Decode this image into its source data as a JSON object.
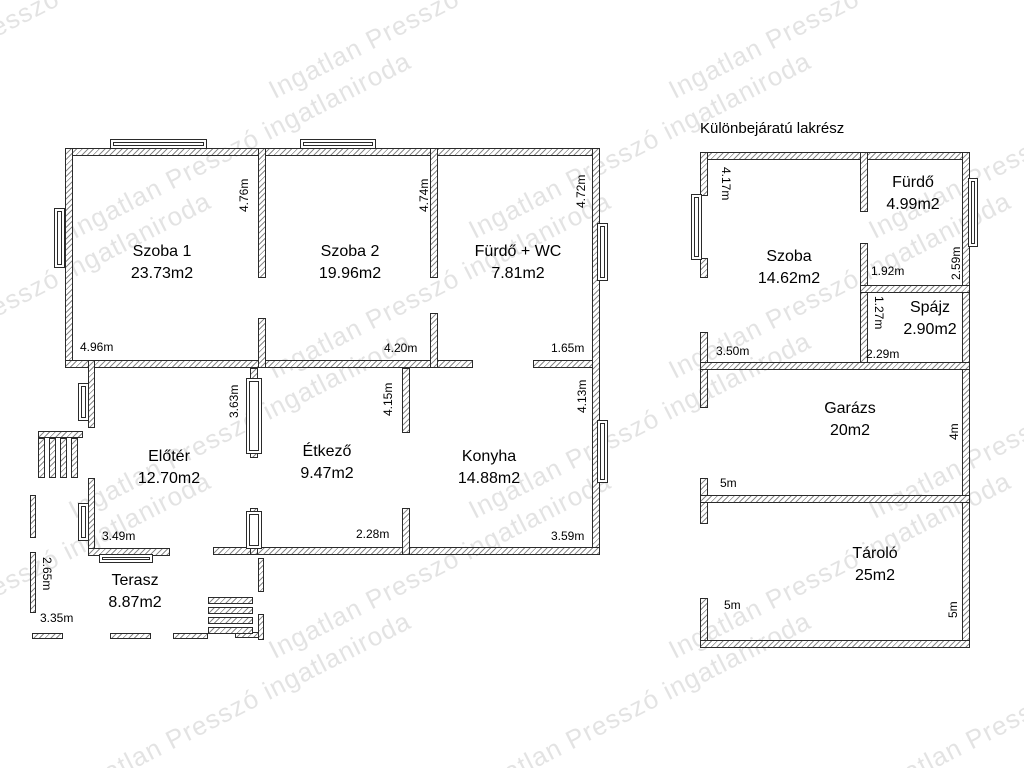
{
  "title": "Különbejáratú lakrész",
  "watermark": "Ingatlan Presszó ingatlaniroda",
  "colors": {
    "line": "#2a2a2a",
    "text": "#000000",
    "watermark": "#dedede",
    "background": "#ffffff"
  },
  "rooms": [
    {
      "name": "Szoba 1",
      "area": "23.73m2"
    },
    {
      "name": "Szoba 2",
      "area": "19.96m2"
    },
    {
      "name": "Fürdő + WC",
      "area": "7.81m2"
    },
    {
      "name": "Előtér",
      "area": "12.70m2"
    },
    {
      "name": "Étkező",
      "area": "9.47m2"
    },
    {
      "name": "Konyha",
      "area": "14.88m2"
    },
    {
      "name": "Terasz",
      "area": "8.87m2"
    },
    {
      "name": "Szoba",
      "area": "14.62m2"
    },
    {
      "name": "Fürdő",
      "area": "4.99m2"
    },
    {
      "name": "Spájz",
      "area": "2.90m2"
    },
    {
      "name": "Garázs",
      "area": "20m2"
    },
    {
      "name": "Tároló",
      "area": "25m2"
    }
  ],
  "dims": [
    "4.96m",
    "4.76m",
    "4.74m",
    "4.72m",
    "4.20m",
    "1.65m",
    "3.63m",
    "4.15m",
    "4.13m",
    "3.49m",
    "2.28m",
    "3.59m",
    "2.65m",
    "3.35m",
    "4.17m",
    "3.50m",
    "2.29m",
    "1.92m",
    "2.59m",
    "1.27m",
    "4m",
    "5m",
    "5m",
    "5m"
  ]
}
